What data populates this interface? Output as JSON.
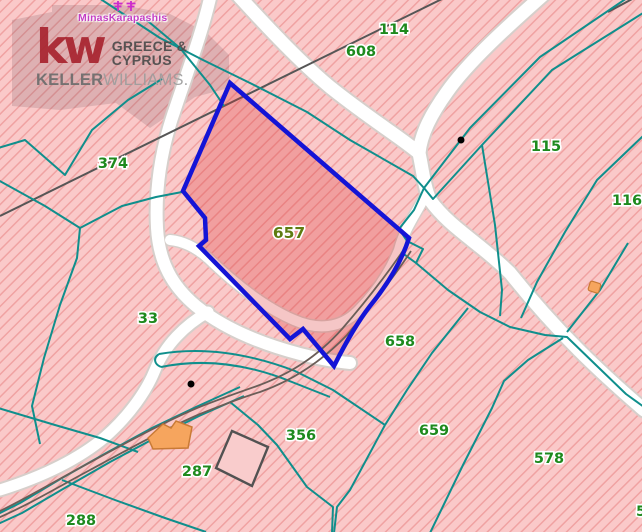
{
  "watermark": {
    "agent_name": "MinasKarapashis",
    "kw_mark": "kw",
    "region_line1": "GREECE &",
    "region_line2": "CYPRUS",
    "brand_bold": "KELLER",
    "brand_light": "WILLIAMS."
  },
  "map": {
    "selected_parcel": "657",
    "parcel_labels": [
      {
        "text": "114",
        "x": 394,
        "y": 34
      },
      {
        "text": "608",
        "x": 361,
        "y": 56
      },
      {
        "text": "115",
        "x": 546,
        "y": 151
      },
      {
        "text": "116",
        "x": 627,
        "y": 205
      },
      {
        "text": "374",
        "x": 113,
        "y": 168
      },
      {
        "text": "657",
        "x": 289,
        "y": 238,
        "selected": true
      },
      {
        "text": "33",
        "x": 148,
        "y": 323
      },
      {
        "text": "658",
        "x": 400,
        "y": 346
      },
      {
        "text": "659",
        "x": 434,
        "y": 435
      },
      {
        "text": "356",
        "x": 301,
        "y": 440
      },
      {
        "text": "287",
        "x": 197,
        "y": 476
      },
      {
        "text": "578",
        "x": 549,
        "y": 463
      },
      {
        "text": "288",
        "x": 81,
        "y": 525
      },
      {
        "text": "5",
        "x": 641,
        "y": 516
      }
    ],
    "point_markers": [
      {
        "name": "well-dot",
        "x": 461,
        "y": 140
      },
      {
        "name": "well-dot",
        "x": 191,
        "y": 384
      }
    ],
    "colors": {
      "background_pink": "#fac9c9",
      "hatch_stripe": "#f0a2a2",
      "boundary_teal": "#0f8f8c",
      "road_white": "#ffffff",
      "road_casing": "#d6cfcb",
      "selection_blue": "#1414d6",
      "selection_fill": "rgba(220,50,50,0.28)",
      "label_green": "#1e8a1e",
      "label_selected_olive": "#5e7c10",
      "kw_red": "#a8242f",
      "agent_magenta": "#c43fc4",
      "building_orange": "#f6a55e",
      "track_gray": "#6b5e58",
      "line_gray": "#565656"
    }
  }
}
